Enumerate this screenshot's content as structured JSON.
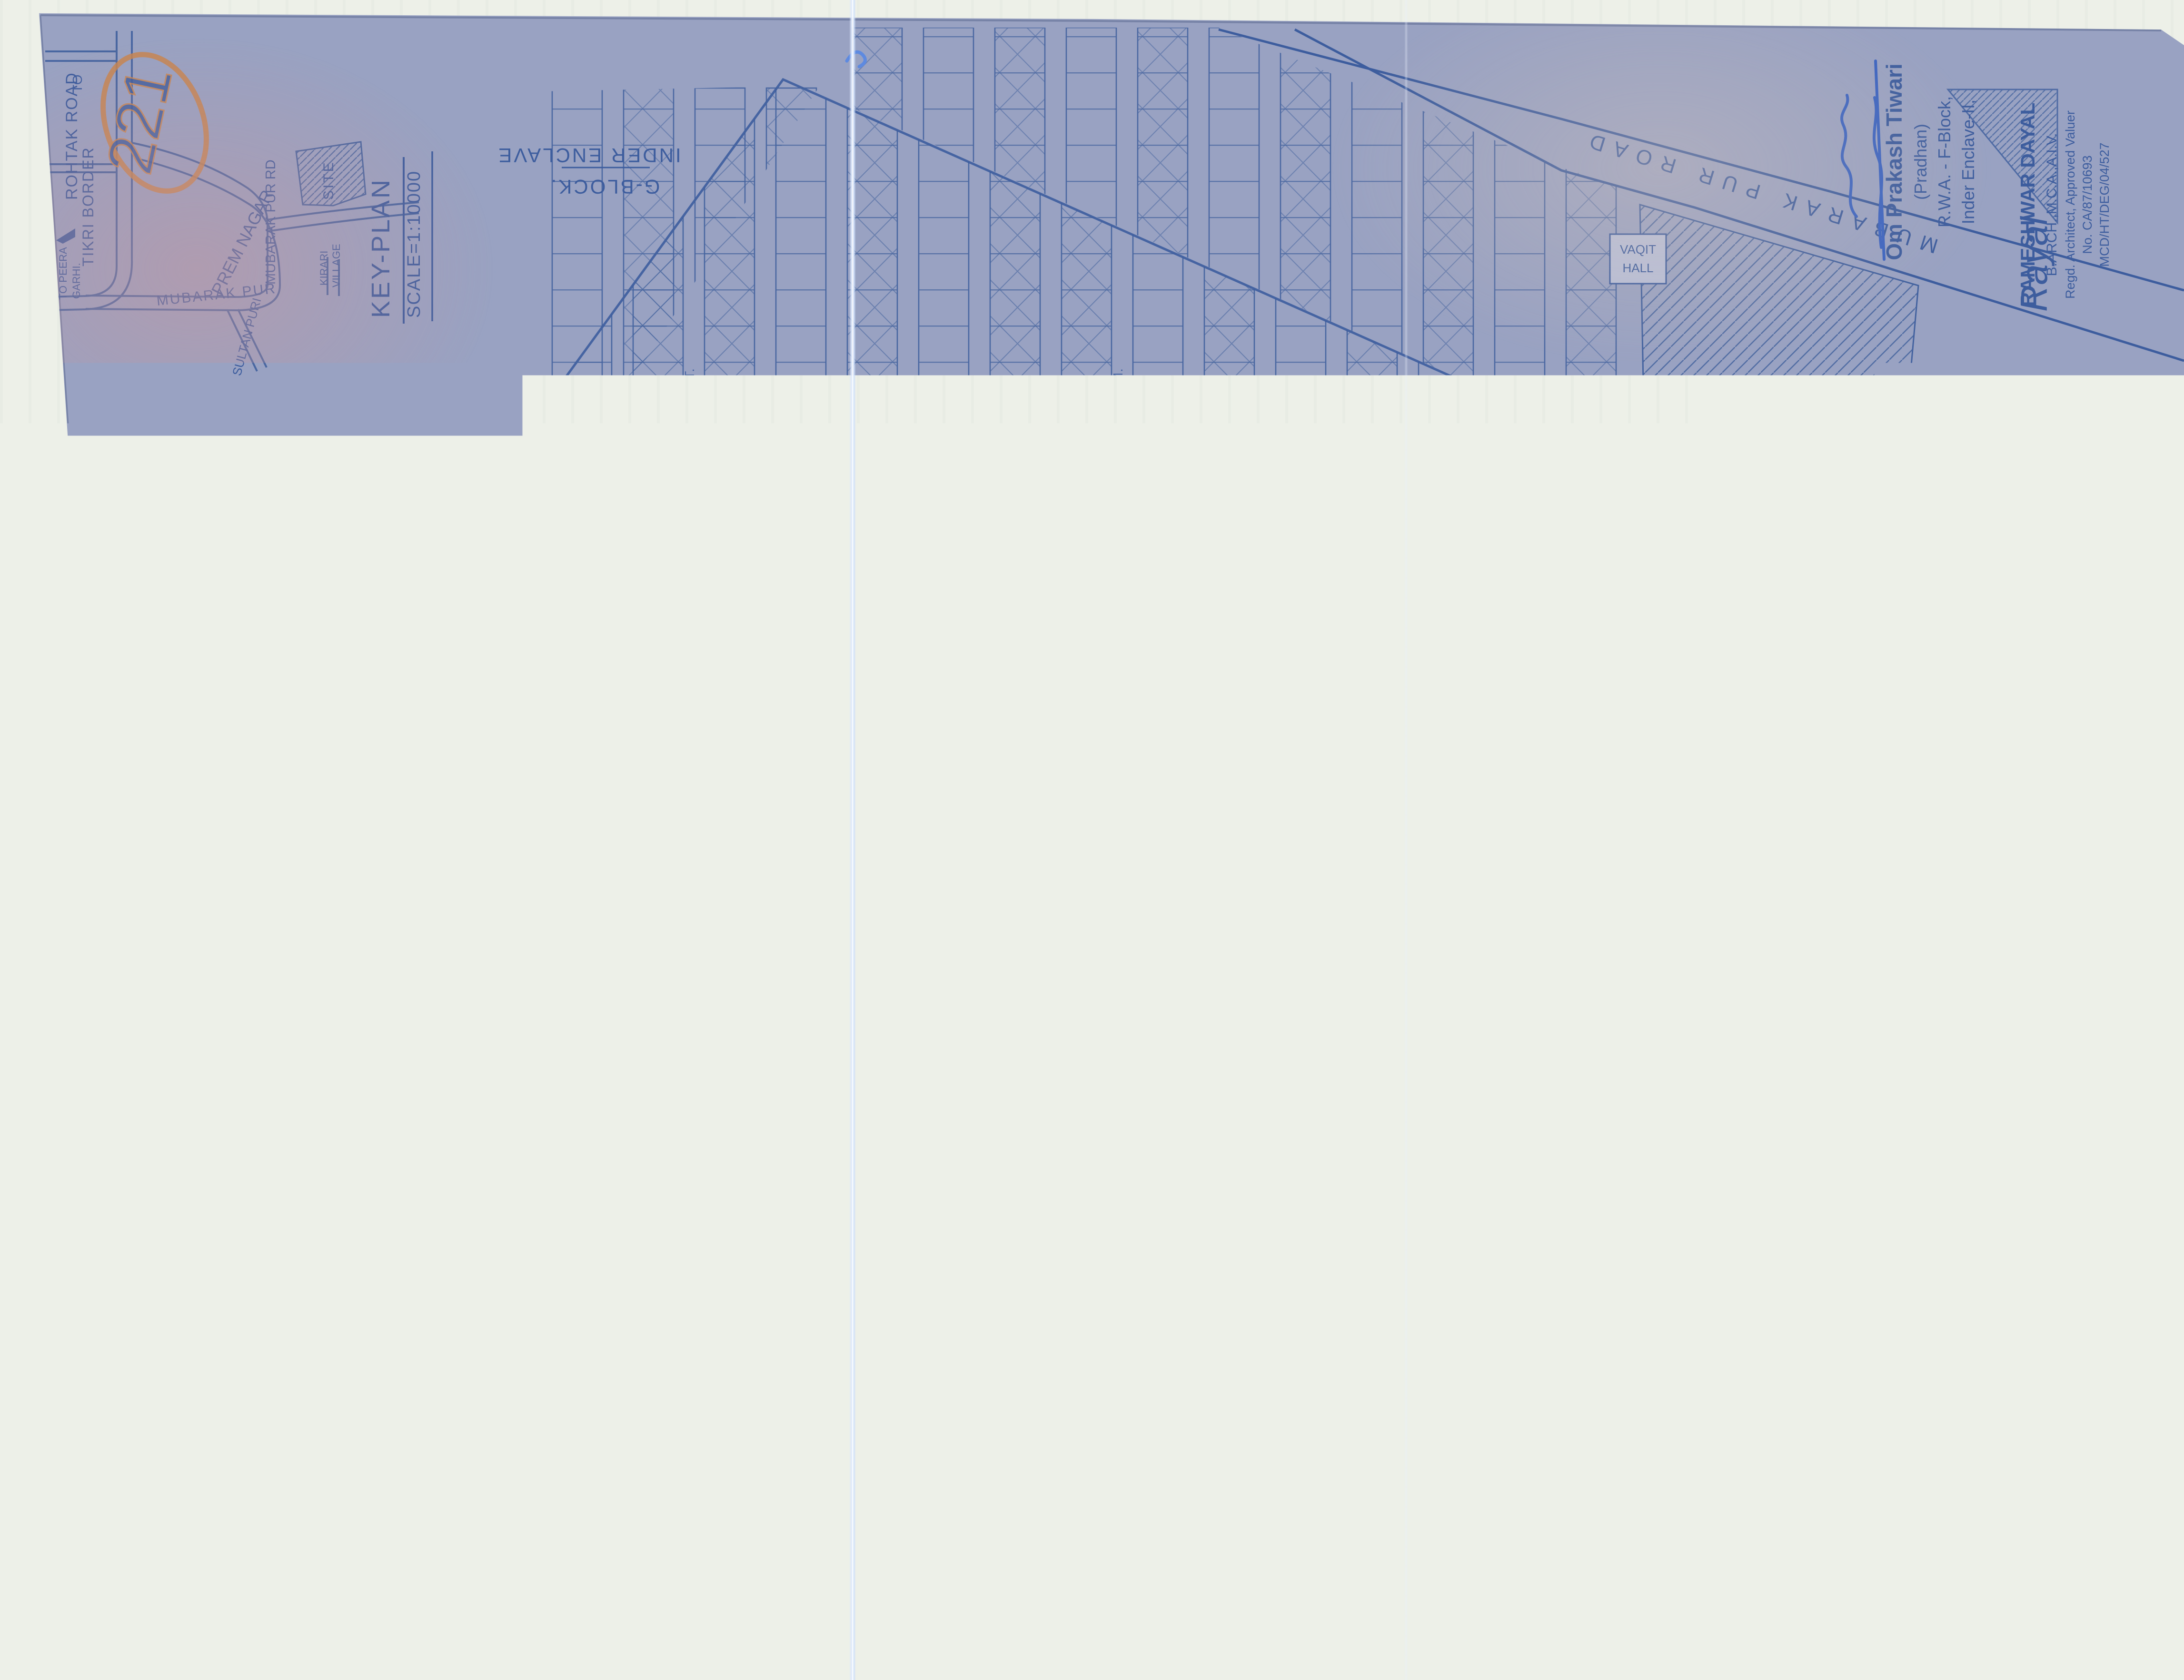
{
  "page": {
    "sheet_number": "221",
    "handwritten_marker": "S/1655",
    "colors": {
      "paper": "#99a2c2",
      "ink": "#3d5d9e",
      "orange": "#c7854f",
      "stamp_purple": "#7a58a8",
      "stamp_magenta": "#b04a93",
      "signature_blue": "#3a63c0",
      "marker_blue": "#2c4c94"
    }
  },
  "title": {
    "line1": "LAY-OUT - PLAN OF F-BLOCK, INDER ENCLAVE.",
    "line2": "PHASE-II, MUBARAK PUR ROAD DELHI-",
    "line3": "FOR: R.W.A. F-BLOCK INDER ENCLAVE, PH-II. DELHI.",
    "scale_note": "SCALE = 1:1000"
  },
  "legend": {
    "heading": "LEGEND: TOTAL PLOT-1152.",
    "item_built": "1-BUILT-UP PLOT MARK-⊠-921",
    "item_vacant": "2-VACANT PLOT MARK-□-231"
  },
  "north_label": "N",
  "key_plan": {
    "title": "KEY-PLAN",
    "scale": "SCALE=1:10000",
    "to_note": "TO",
    "tikri": "TIKRI BORDER",
    "rohtak": "ROHTAK ROAD",
    "peera1": "TO PEERA",
    "peera2": "GARHI.",
    "prem": "PREM NAGAR",
    "mubarak_rd": "MUBARAK PUR RD",
    "mubarak_pur": "MUBARAK PUR",
    "kirari1": "KIRARI",
    "kirari2": "VILLAGE",
    "sultan": "SULTAN PURI",
    "site": "SITE"
  },
  "blocks": {
    "g_line1": "G-BLOCK.",
    "g_line2": "INDER ENCLAVE",
    "e_line1": "E-BLOCK",
    "e_line2": "PH-II. INDER ENCLAVE",
    "masjid": "MASJID."
  },
  "roads": {
    "top": "MUBARAK PUR ROAD",
    "right": "MUBARAK PUR ROAD",
    "band1": "R O A D   7.6 M.   W I D E",
    "band2": "R O A D   7.6 M.   W I D E",
    "band3": "R O A D   7.6 M.   W I D E",
    "band4": "R O A D   6.1 M.   W I D E",
    "vertical": "ROAD-6.1 M.",
    "flip": "ROAD 7.6 M.",
    "galis": [
      "GALI-4.5 MT.",
      "GALI 6 M.",
      "GALI 4.5 M.",
      "GALI 4.57 M.",
      "GALI-4.5 M.",
      "GALI 6.1 M.",
      "GALI 4.5 M.",
      "GALI-4.57 MT.",
      "GALI 6 M.",
      "GALI 4.5 M.",
      "GALI 7.6 M.",
      "GALI 4.5 M.",
      "GALI-6 M.",
      "GALI 4.5 M.",
      "GALI 4.57 M.",
      "GALI 6.1 M.",
      "GALI 4.5 M.",
      "GALI-4.5 MT.",
      "GALI 6 M.",
      "GALI 4.5 M.",
      "GALI 7.6 M."
    ]
  },
  "area_labels": {
    "portion": "PORTION OF VIDHYA PATI NAGAR",
    "nagar": "V I D H Y A    P A T I    N A G A R",
    "hospital": "HOSPITAL",
    "hall1": "VAQIT",
    "hall2": "HALL",
    "elect": "ELECT. TRAN."
  },
  "stamps": {
    "pradhan": {
      "line1": "Om Prakash Tiwari",
      "line2": "(Pradhan)",
      "line3": "R.W.A. - F-Block,",
      "line4": "Inder Enclave-II,"
    },
    "architect": {
      "line1": "RAMESHWAR DAYAL",
      "line2": "B.ARCH.,M.C.A.,A.I.V.",
      "line3": "Regd. Architect, Approved Valuer",
      "line4": "No. CA/87/10693",
      "line5": "MCD/HT/DEG/04/527"
    },
    "signature": "Rayal"
  }
}
